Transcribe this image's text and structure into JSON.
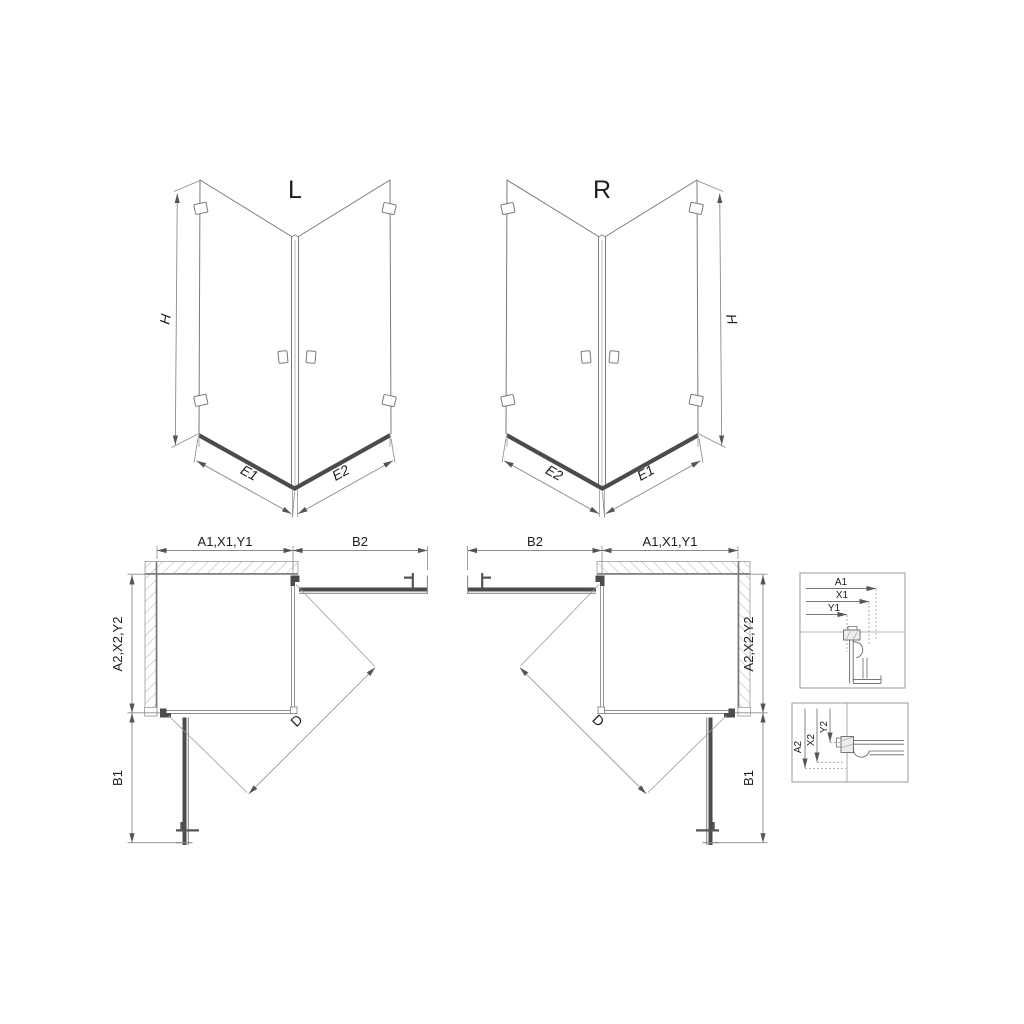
{
  "drawing": {
    "iso_left": {
      "variant": "L",
      "height": "H",
      "edge_left": "E1",
      "edge_right": "E2"
    },
    "iso_right": {
      "variant": "R",
      "height": "H",
      "edge_left": "E2",
      "edge_right": "E1"
    },
    "plan_left": {
      "width_top": "A1,X1,Y1",
      "door_top": "B2",
      "depth_side": "A2,X2,Y2",
      "door_side": "B1",
      "diagonal": "D"
    },
    "plan_right": {
      "door_top": "B2",
      "width_top": "A1,X1,Y1",
      "depth_side": "A2,X2,Y2",
      "door_side": "B1",
      "diagonal": "D"
    },
    "detail_top": {
      "dims": [
        "A1",
        "X1",
        "Y1"
      ]
    },
    "detail_bottom": {
      "dims": [
        "A2",
        "X2",
        "Y2"
      ]
    },
    "colors": {
      "background": "#ffffff",
      "line": "#7a7a7a",
      "dark": "#4b4b4b",
      "dimension": "#8a8a8a",
      "text": "#1c1c1c"
    }
  }
}
